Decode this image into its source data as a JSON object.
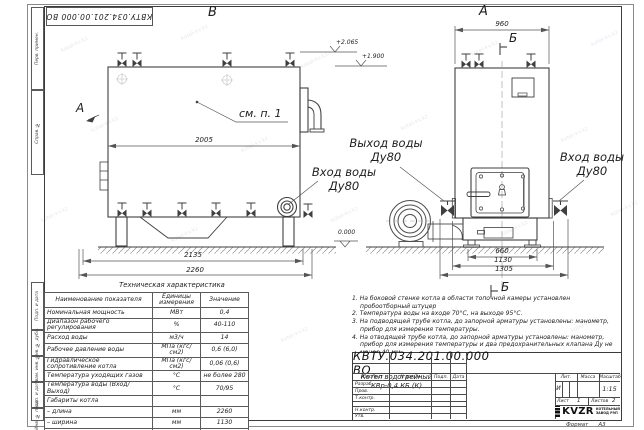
{
  "sheet": {
    "doc_number_top": "КВТУ.034.201.00.000  ВО",
    "format_label": "Формат",
    "format_value": "А3",
    "watermark": "kotel-kv.kz"
  },
  "margin_labels": [
    "Перв. примен.",
    "Справ. №",
    "Подп. и дата",
    "Инв. № дубл.",
    "Взам. инв. №",
    "Подп. и дата",
    "Инв. № подл."
  ],
  "views": {
    "left_label": "В",
    "right_label": "А",
    "view_arrow_label": "А",
    "callout": "см. п. 1",
    "section_marker_top": "Б",
    "section_marker_bottom": "Б",
    "dims": {
      "side_width": "2005",
      "side_base": "2135",
      "side_overall": "2260",
      "front_top": "960",
      "front_legs": "660",
      "front_body": "1130",
      "front_full": "1305"
    },
    "elevations": {
      "top": "+2.065",
      "mid": "+1.900",
      "zero": "0.000"
    },
    "labels": {
      "outlet_1": "Выход воды",
      "outlet_2": "Ду80",
      "inlet_right_1": "Вход воды",
      "inlet_right_2": "Ду80",
      "inlet_left_1": "Вход воды",
      "inlet_left_2": "Ду80"
    }
  },
  "spec_table": {
    "title": "Техническая характеристика",
    "headers": [
      "Наименование показателя",
      "Единицы измерения",
      "Значение"
    ],
    "rows": [
      [
        "Номинальная мощность",
        "МВт",
        "0,4"
      ],
      [
        "Диапазон рабочего регулирования",
        "%",
        "40-110"
      ],
      [
        "Расход воды",
        "м3/ч",
        "14"
      ],
      [
        "Рабочее давление воды",
        "МПа (кгс/см2)",
        "0,6 (6,0)"
      ],
      [
        "Гидравлическое сопротивление котла",
        "МПа (кгс/см2)",
        "0,06 (0,6)"
      ],
      [
        "Температура уходящих газов",
        "°С",
        "не более 280"
      ],
      [
        "Температура воды (Вход/Выход)",
        "°С",
        "70/95"
      ],
      [
        "Габариты котла",
        "",
        ""
      ],
      [
        "– длина",
        "мм",
        "2260"
      ],
      [
        "– ширина",
        "мм",
        "1130"
      ],
      [
        "– высота",
        "мм",
        "1950"
      ]
    ]
  },
  "notes": [
    "1. На боковой стенке котла в области топочной камеры установлен пробоотборный штуцер",
    "2. Температура воды на входе 70°С, на выходе 95°С.",
    "3. На подводящей трубе котла, до запорной арматуры установлены: манометр, прибор для измерения температуры.",
    "4. На отводящей трубе котла, до запорной арматуры установлены: манометр, прибор для измерения температуры и два предохранительных клапана Ду не менее 40 мм.",
    "5. Остальные технические требования по ОСТ 108.030.133-84."
  ],
  "title_block": {
    "doc_number": "КВТУ.034.201.00.000  ВО",
    "product_name_1": "Котел водогрейный",
    "product_name_2": "КВр-0,4  КБ  (К)",
    "col_headers": [
      "Изм.Лист",
      "N докум.",
      "Подп.",
      "Дата"
    ],
    "row_labels": [
      "Разраб.",
      "Пров.",
      "Т.контр.",
      "Н.контр.",
      "Утв."
    ],
    "lit_header": "Лит.",
    "mass_header": "Масса",
    "scale_header": "Масштаб",
    "lit_value": "И",
    "scale_value": "1:15",
    "sheet_label": "Лист",
    "sheet_value": "1",
    "sheets_label": "Листов",
    "sheets_value": "2",
    "company": "KVZR",
    "company_line1": "КОТЕЛЬНЫЙ",
    "company_line2": "ЗАВОД РЭП"
  }
}
